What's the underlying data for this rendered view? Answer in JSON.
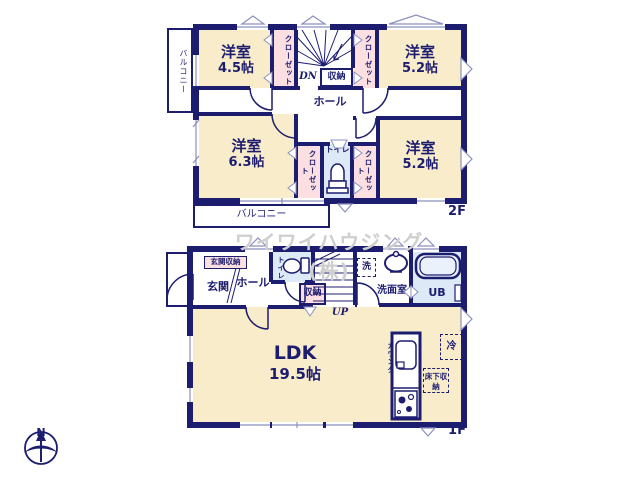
{
  "watermark": "ワイワイハウジング(株)",
  "floor2": {
    "label": "2F",
    "balcony_left": "バルコニー",
    "balcony_bottom": "バルコニー",
    "room_nw": {
      "name": "洋室",
      "size": "4.5帖"
    },
    "room_ne": {
      "name": "洋室",
      "size": "5.2帖"
    },
    "room_sw": {
      "name": "洋室",
      "size": "6.3帖"
    },
    "room_se": {
      "name": "洋室",
      "size": "5.2帖"
    },
    "closet": "クローゼット",
    "hall": "ホール",
    "storage": "収納",
    "toilet": "トイレ",
    "stairs_dn": "DN"
  },
  "floor1": {
    "label": "1F",
    "entrance": "玄関",
    "entrance_storage": "玄関収納",
    "hall": "ホール",
    "toilet": "トイレ",
    "storage": "収納",
    "stairs_up": "UP",
    "laundry": "洗",
    "washroom": "洗面室",
    "bath": "UB",
    "ldk": {
      "name": "LDK",
      "size": "19.5帖"
    },
    "counter": "カウンター",
    "floor_storage": "床下収納",
    "fridge": "冷"
  },
  "compass": {
    "north": "N"
  }
}
